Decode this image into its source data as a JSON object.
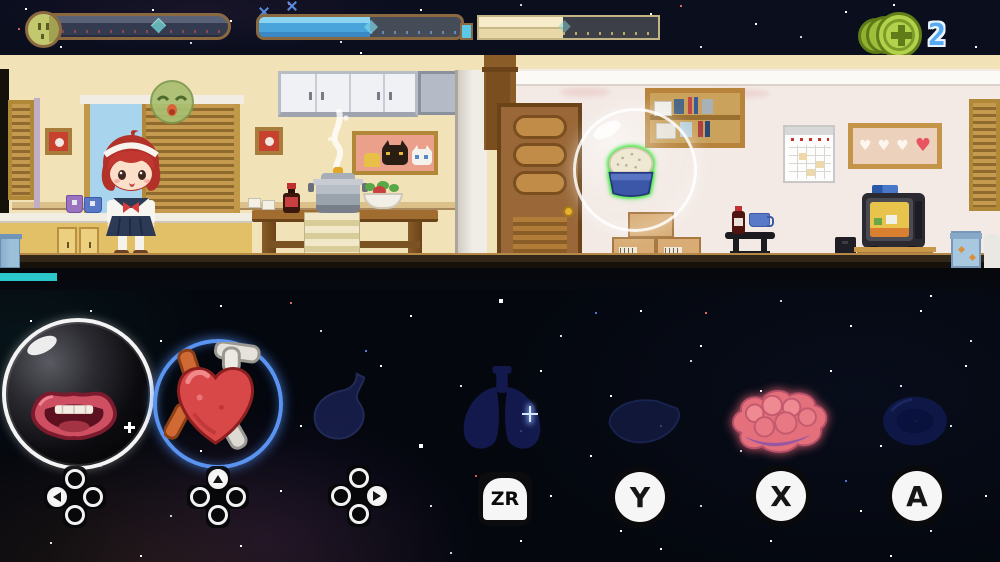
{
  "hud": {
    "bars": [
      {
        "name": "mood",
        "icon": "face-icon",
        "fill_percent": 0,
        "marker_percent": 64
      },
      {
        "name": "water",
        "icon": "bottle-bar",
        "fill_percent": 55
      },
      {
        "name": "energy",
        "fill_percent": 47
      }
    ],
    "coins": {
      "icon": "coin-stack-icon",
      "count": "2"
    },
    "task_progress_percent": 6
  },
  "scene": {
    "emote": "drowsy-face-emote",
    "highlighted_item": "rice-bowl"
  },
  "organs": [
    {
      "name": "mouth",
      "control": "dpad-left",
      "state": "bubbled"
    },
    {
      "name": "heart",
      "control": "dpad-up",
      "state": "selected"
    },
    {
      "name": "stomach",
      "control": "dpad-right",
      "state": "dormant"
    },
    {
      "name": "lungs",
      "control": "ZR",
      "state": "dormant",
      "button_label": "ZR"
    },
    {
      "name": "liver",
      "control": "Y",
      "state": "dormant",
      "button_label": "Y"
    },
    {
      "name": "brain",
      "control": "X",
      "state": "awake",
      "button_label": "X"
    },
    {
      "name": "cell",
      "control": "A",
      "state": "dormant",
      "button_label": "A"
    }
  ],
  "colors": {
    "selection_ring": "#5a94f0",
    "item_highlight": "#2be82b",
    "water_fill": "#4aa4dc",
    "energy_fill": "#f2e6c0",
    "progress_teal": "#2bc8cb",
    "coin_green": "#a9c83d"
  }
}
